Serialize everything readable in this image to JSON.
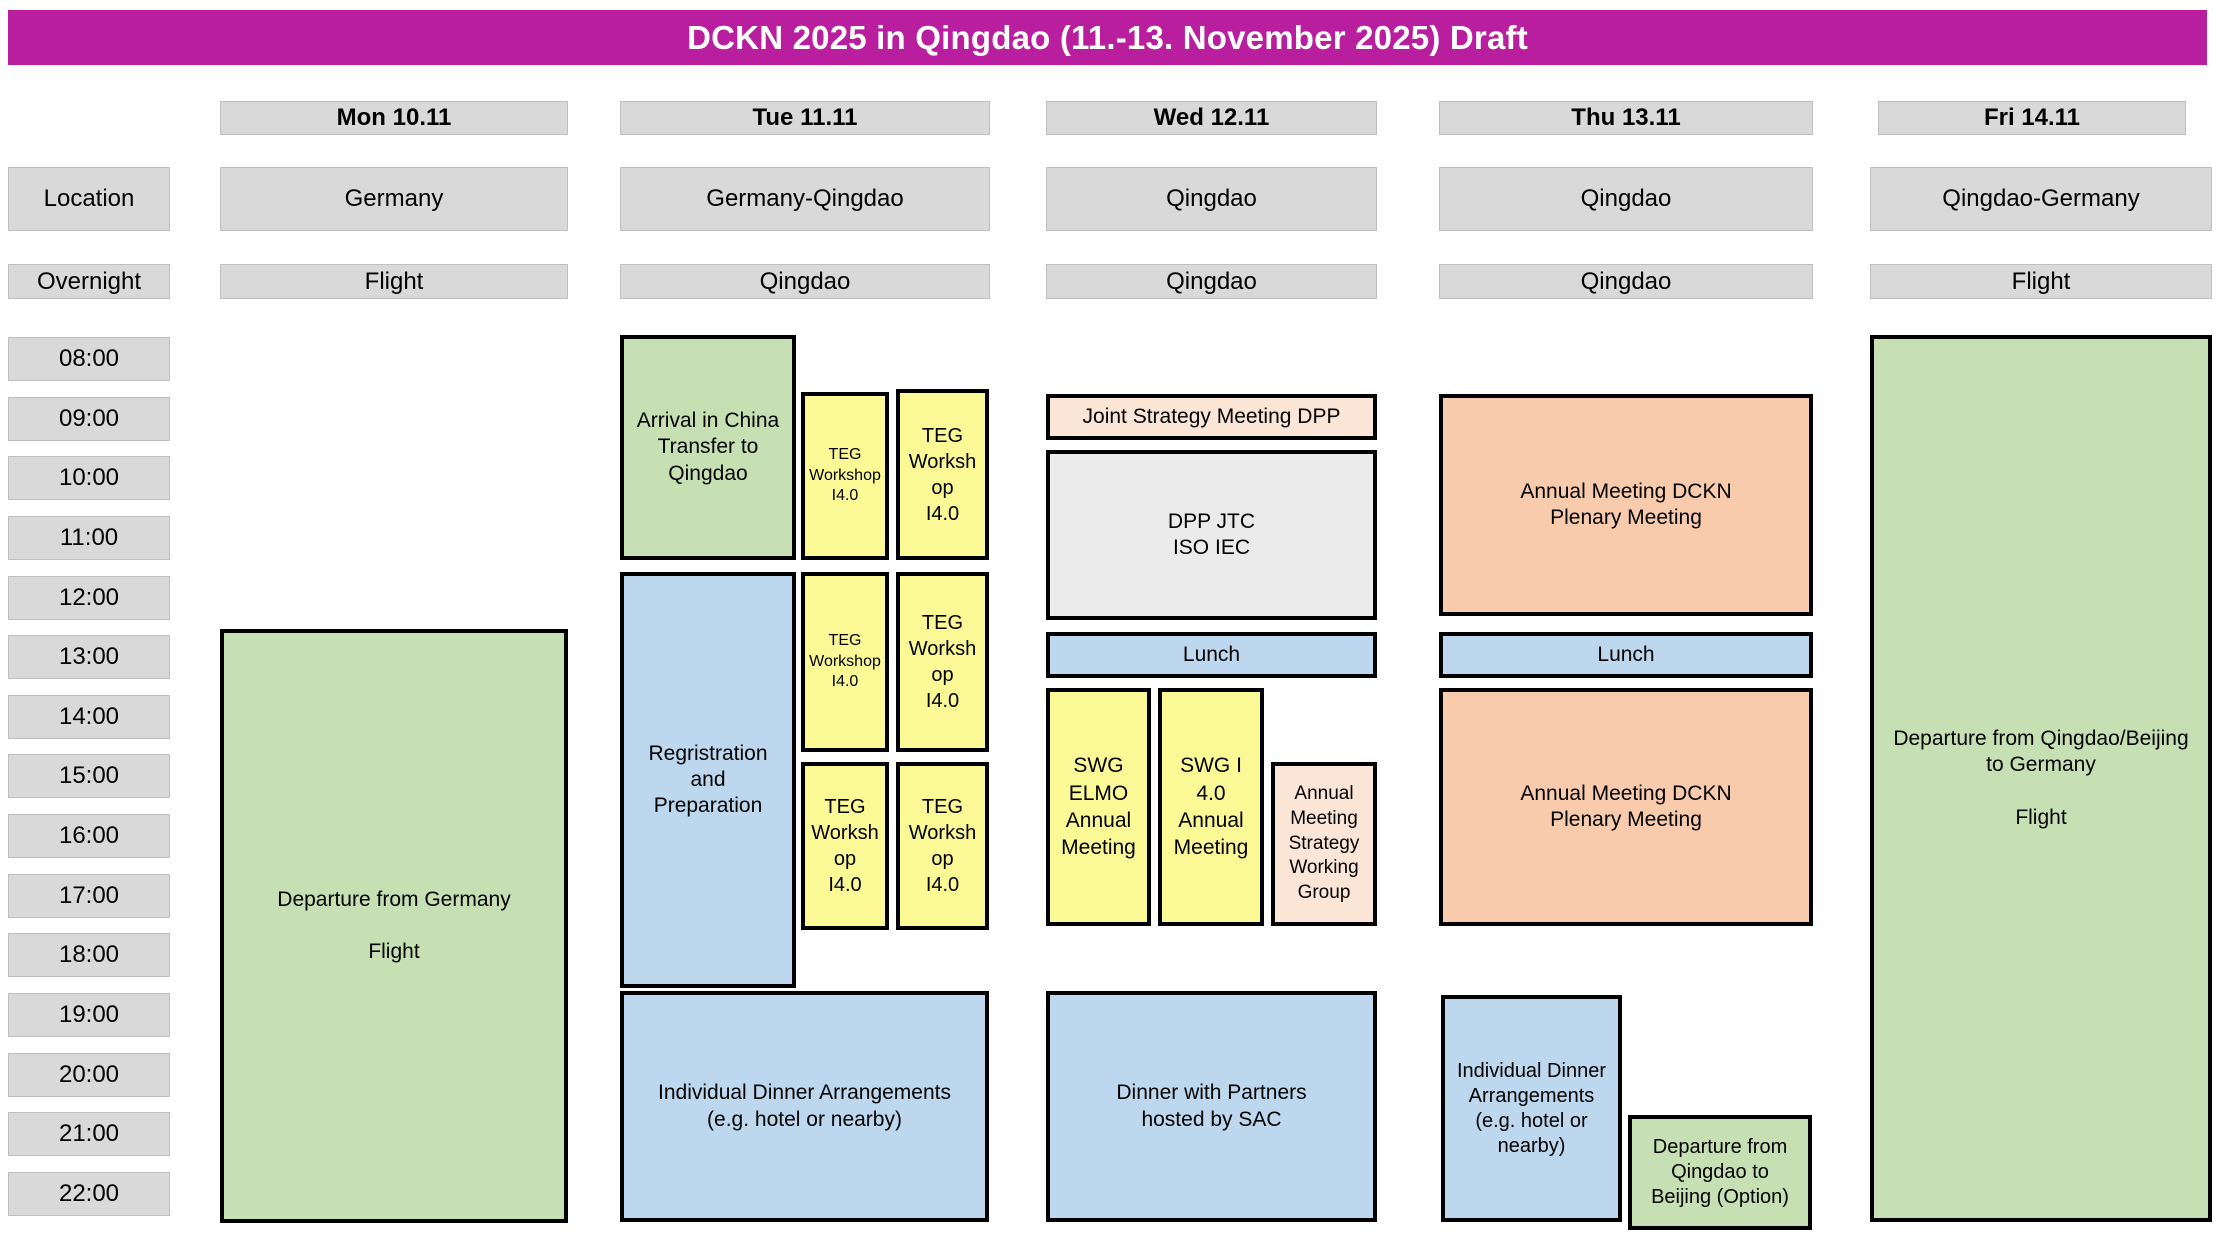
{
  "title": "DCKN 2025 in Qingdao (11.-13. November 2025) Draft",
  "row_labels": {
    "location": "Location",
    "overnight": "Overnight"
  },
  "days": [
    {
      "id": "mon",
      "header": "Mon 10.11",
      "location": "Germany",
      "overnight": "Flight"
    },
    {
      "id": "tue",
      "header": "Tue 11.11",
      "location": "Germany-Qingdao",
      "overnight": "Qingdao"
    },
    {
      "id": "wed",
      "header": "Wed 12.11",
      "location": "Qingdao",
      "overnight": "Qingdao"
    },
    {
      "id": "thu",
      "header": "Thu 13.11",
      "location": "Qingdao",
      "overnight": "Qingdao"
    },
    {
      "id": "fri",
      "header": "Fri 14.11",
      "location": "Qingdao-Germany",
      "overnight": "Flight"
    }
  ],
  "times": [
    "08:00",
    "09:00",
    "10:00",
    "11:00",
    "12:00",
    "13:00",
    "14:00",
    "15:00",
    "16:00",
    "17:00",
    "18:00",
    "19:00",
    "20:00",
    "21:00",
    "22:00"
  ],
  "colors": {
    "title_bg": "#B81E9E",
    "title_text": "#FFFFFF",
    "header_cell": "#D9D9D9",
    "green": "#C6E0B4",
    "yellow": "#FBF896",
    "blue": "#BDD7EE",
    "orange": "#F8CBAD",
    "peach": "#FBE5D6",
    "lightgray": "#EBEBEB",
    "event_border": "#000000"
  },
  "events": [
    {
      "id": "mon-departure",
      "day": "mon",
      "slot": "full",
      "start": 12.9,
      "end": 22.85,
      "color": "green",
      "label": "Departure from Germany\n\nFlight"
    },
    {
      "id": "tue-arrival",
      "day": "tue",
      "slot": "main",
      "start": 7.97,
      "end": 11.74,
      "color": "green",
      "label": "Arrival in China\nTransfer to\nQingdao"
    },
    {
      "id": "tue-teg-1a",
      "day": "tue",
      "slot": "sub1",
      "start": 8.92,
      "end": 11.74,
      "color": "yellow",
      "label": "TEG\nWorkshop\nI4.0"
    },
    {
      "id": "tue-teg-1b",
      "day": "tue",
      "slot": "sub2",
      "start": 8.87,
      "end": 11.74,
      "color": "yellow",
      "label": "TEG\nWorksh\nop\nI4.0"
    },
    {
      "id": "tue-registration",
      "day": "tue",
      "slot": "main",
      "start": 11.94,
      "end": 18.92,
      "color": "blue",
      "label": "Regristration\nand\nPreparation"
    },
    {
      "id": "tue-teg-2a",
      "day": "tue",
      "slot": "sub1",
      "start": 11.94,
      "end": 14.96,
      "color": "yellow",
      "label": "TEG\nWorkshop\nI4.0"
    },
    {
      "id": "tue-teg-2b",
      "day": "tue",
      "slot": "sub2",
      "start": 11.94,
      "end": 14.96,
      "color": "yellow",
      "label": "TEG\nWorksh\nop\nI4.0"
    },
    {
      "id": "tue-teg-3a",
      "day": "tue",
      "slot": "sub1",
      "start": 15.13,
      "end": 17.94,
      "color": "yellow",
      "label": "TEG\nWorksh\nop\nI4.0"
    },
    {
      "id": "tue-teg-3b",
      "day": "tue",
      "slot": "sub2",
      "start": 15.13,
      "end": 17.94,
      "color": "yellow",
      "label": "TEG\nWorksh\nop\nI4.0"
    },
    {
      "id": "tue-dinner",
      "day": "tue",
      "slot": "full",
      "start": 18.97,
      "end": 22.84,
      "color": "blue",
      "label": "Individual Dinner Arrangements\n(e.g. hotel or nearby)"
    },
    {
      "id": "wed-joint-strategy",
      "day": "wed",
      "slot": "full",
      "start": 8.96,
      "end": 9.73,
      "color": "peach",
      "label": "Joint Strategy Meeting DPP"
    },
    {
      "id": "wed-dpp-jtc",
      "day": "wed",
      "slot": "full",
      "start": 9.89,
      "end": 12.75,
      "color": "lightgray",
      "label": "DPP JTC\nISO IEC"
    },
    {
      "id": "wed-lunch",
      "day": "wed",
      "slot": "full",
      "start": 12.95,
      "end": 13.72,
      "color": "blue",
      "label": "Lunch"
    },
    {
      "id": "wed-swg-elmo",
      "day": "wed",
      "slot": "third1",
      "start": 13.89,
      "end": 17.88,
      "color": "yellow",
      "label": "SWG\nELMO\nAnnual\nMeeting"
    },
    {
      "id": "wed-swg-i40",
      "day": "wed",
      "slot": "third2",
      "start": 13.89,
      "end": 17.88,
      "color": "yellow",
      "label": "SWG I\n4.0\nAnnual\nMeeting"
    },
    {
      "id": "wed-strategy-wg",
      "day": "wed",
      "slot": "third3",
      "start": 15.13,
      "end": 17.88,
      "color": "peach",
      "label": "Annual\nMeeting\nStrategy\nWorking\nGroup"
    },
    {
      "id": "wed-dinner",
      "day": "wed",
      "slot": "full",
      "start": 18.97,
      "end": 22.84,
      "color": "blue",
      "label": "Dinner with Partners\nhosted by SAC"
    },
    {
      "id": "thu-annual-am",
      "day": "thu",
      "slot": "full",
      "start": 8.96,
      "end": 12.68,
      "color": "orange",
      "label": "Annual Meeting DCKN\nPlenary Meeting"
    },
    {
      "id": "thu-lunch",
      "day": "thu",
      "slot": "full",
      "start": 12.95,
      "end": 13.72,
      "color": "blue",
      "label": "Lunch"
    },
    {
      "id": "thu-annual-pm",
      "day": "thu",
      "slot": "full",
      "start": 13.89,
      "end": 17.88,
      "color": "orange",
      "label": "Annual Meeting DCKN\nPlenary Meeting"
    },
    {
      "id": "thu-dinner",
      "day": "thu",
      "slot": "left",
      "start": 19.03,
      "end": 22.84,
      "color": "blue",
      "label": "Individual Dinner\nArrangements\n(e.g. hotel or\nnearby)"
    },
    {
      "id": "thu-departure-beijing",
      "day": "thu",
      "slot": "right",
      "start": 21.04,
      "end": 22.97,
      "color": "green",
      "label": "Departure from\nQingdao to\nBeijing (Option)"
    },
    {
      "id": "fri-departure",
      "day": "fri",
      "slot": "full",
      "start": 7.97,
      "end": 22.84,
      "color": "green",
      "label": "Departure from Qingdao/Beijing\nto Germany\n\nFlight"
    }
  ]
}
